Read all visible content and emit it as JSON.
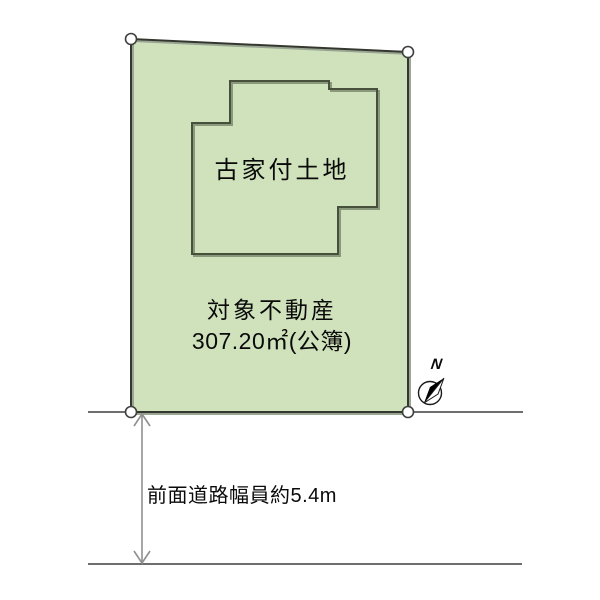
{
  "diagram": {
    "building_label": "古家付土地",
    "parcel_title": "対象不動産",
    "parcel_area": "307.20㎡(公簿)",
    "road_width_label": "前面道路幅員約5.4m",
    "north_label": "N"
  },
  "colors": {
    "parcel_fill": "#d0e2bb",
    "parcel_stroke": "#34372e",
    "parcel_shadow": "#9aa694",
    "building_stroke": "#46503a",
    "building_shadow": "#8a987c",
    "road_line": "#3f3f3f",
    "arrow": "#8f8f8f",
    "marker_fill": "#ffffff",
    "marker_stroke": "#3f3f3f",
    "compass_needle": "#000000",
    "text": "#0a0a0a"
  }
}
